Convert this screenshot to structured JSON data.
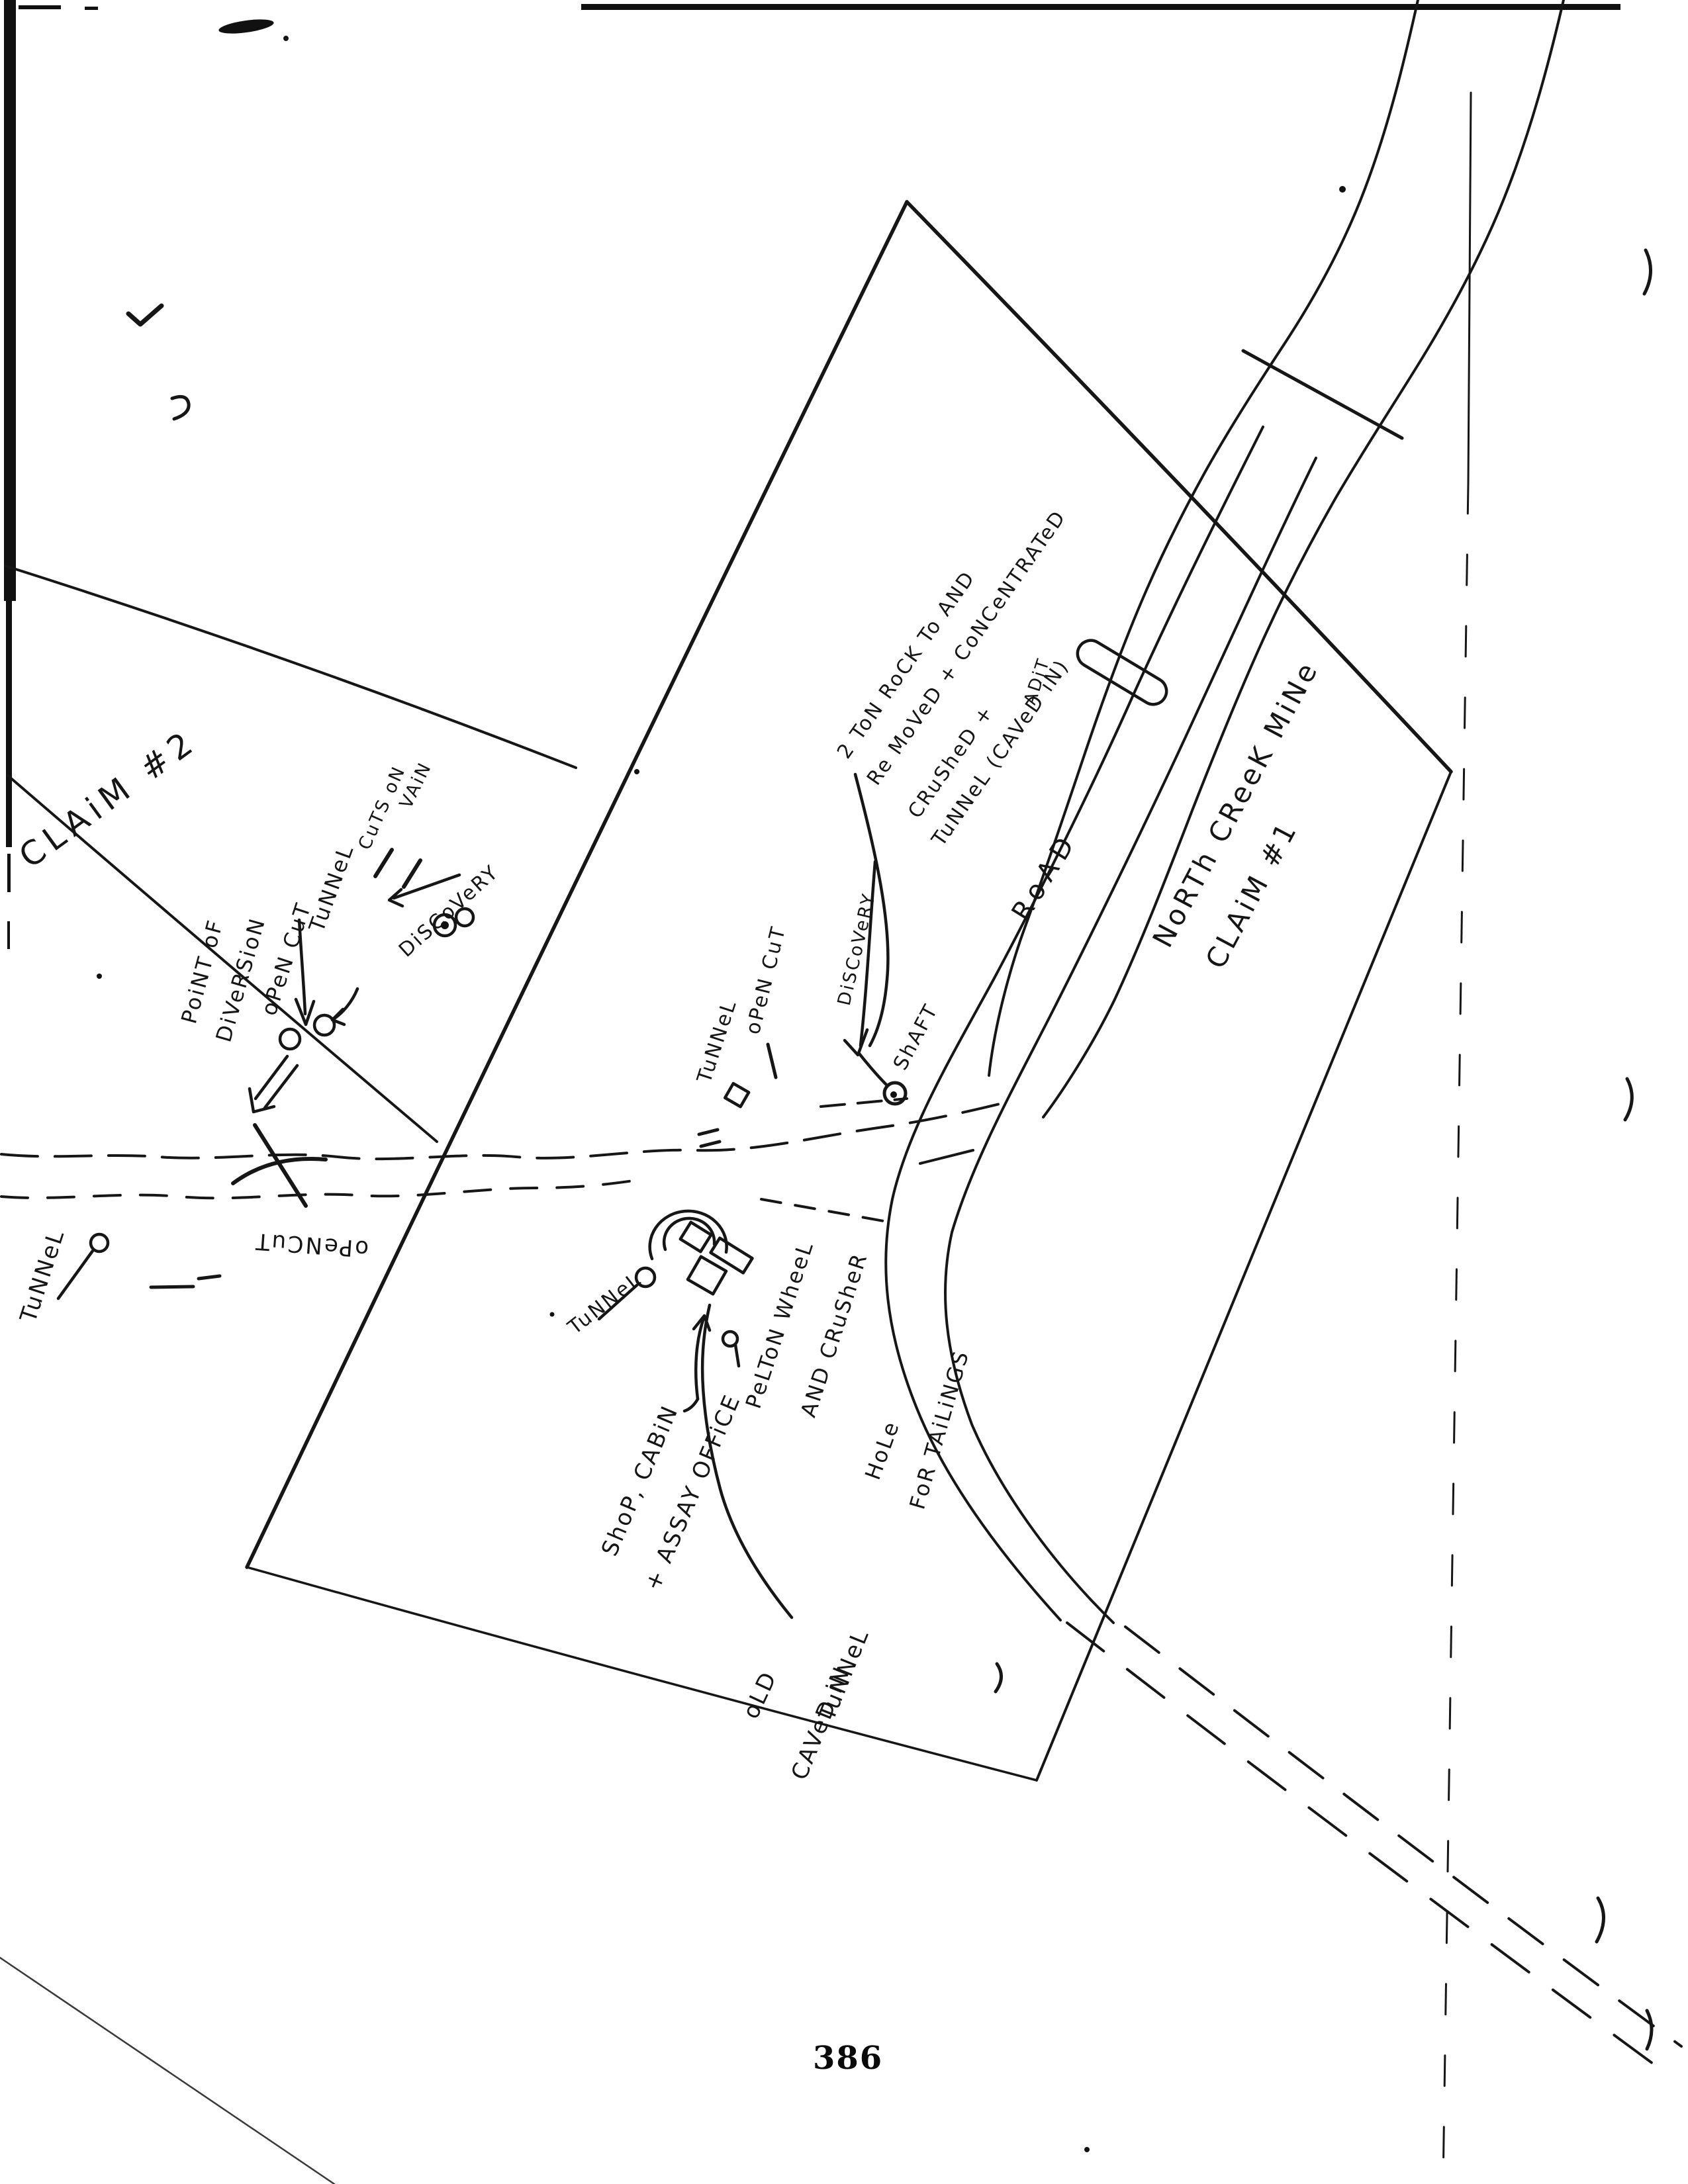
{
  "page": {
    "number": "386",
    "paper_color": "#ffffff",
    "ink_color": "#161616"
  },
  "map": {
    "claim2": {
      "title": "CLAiM #2",
      "labels": {
        "point_of": "PoiNT oF",
        "diversion": "DiVeRSioN",
        "open_cut": "oPeN CuT",
        "tunnel": "TuNNeL",
        "cuts_on": "CuTS oN",
        "vain": "VAiN",
        "discovery": "DiSCoVeRY",
        "tunnel_west": "TuNNeL",
        "open_cut_creek": "oPeNCuT"
      }
    },
    "claim1": {
      "title_line1": "NoRTh CReeK MiNe",
      "title_line2": "CLAiM #1",
      "road": "RoAD",
      "note_line1": "2 ToN RoCK To AND",
      "note_line2": "Re MoVeD + CoNCeNTRATeD",
      "note_line3": "CRuSheD +",
      "note_line4": "TuNNeL (CAVeD iN)",
      "adit": "ADiT",
      "tunnel_mid": "TuNNeL",
      "open_cut_mid": "oPeN CuT",
      "discovery_mid": "DiSCoVeRY",
      "shaft": "ShAFT",
      "shop_line1": "ShoP, CABiN",
      "shop_line2": "+ ASSAY OFFiCE",
      "pelton_line1": "PeLToN WheeL",
      "pelton_line2": "AND CRuSheR",
      "hole_line1": "HoLe",
      "hole_line2": "FoR TAiLiNGS",
      "old_line1": "oLD",
      "old_line2": "CAVeD iN",
      "old_line3": "TuNNeL",
      "tunnel_nw_small": "TuNNeL"
    }
  }
}
